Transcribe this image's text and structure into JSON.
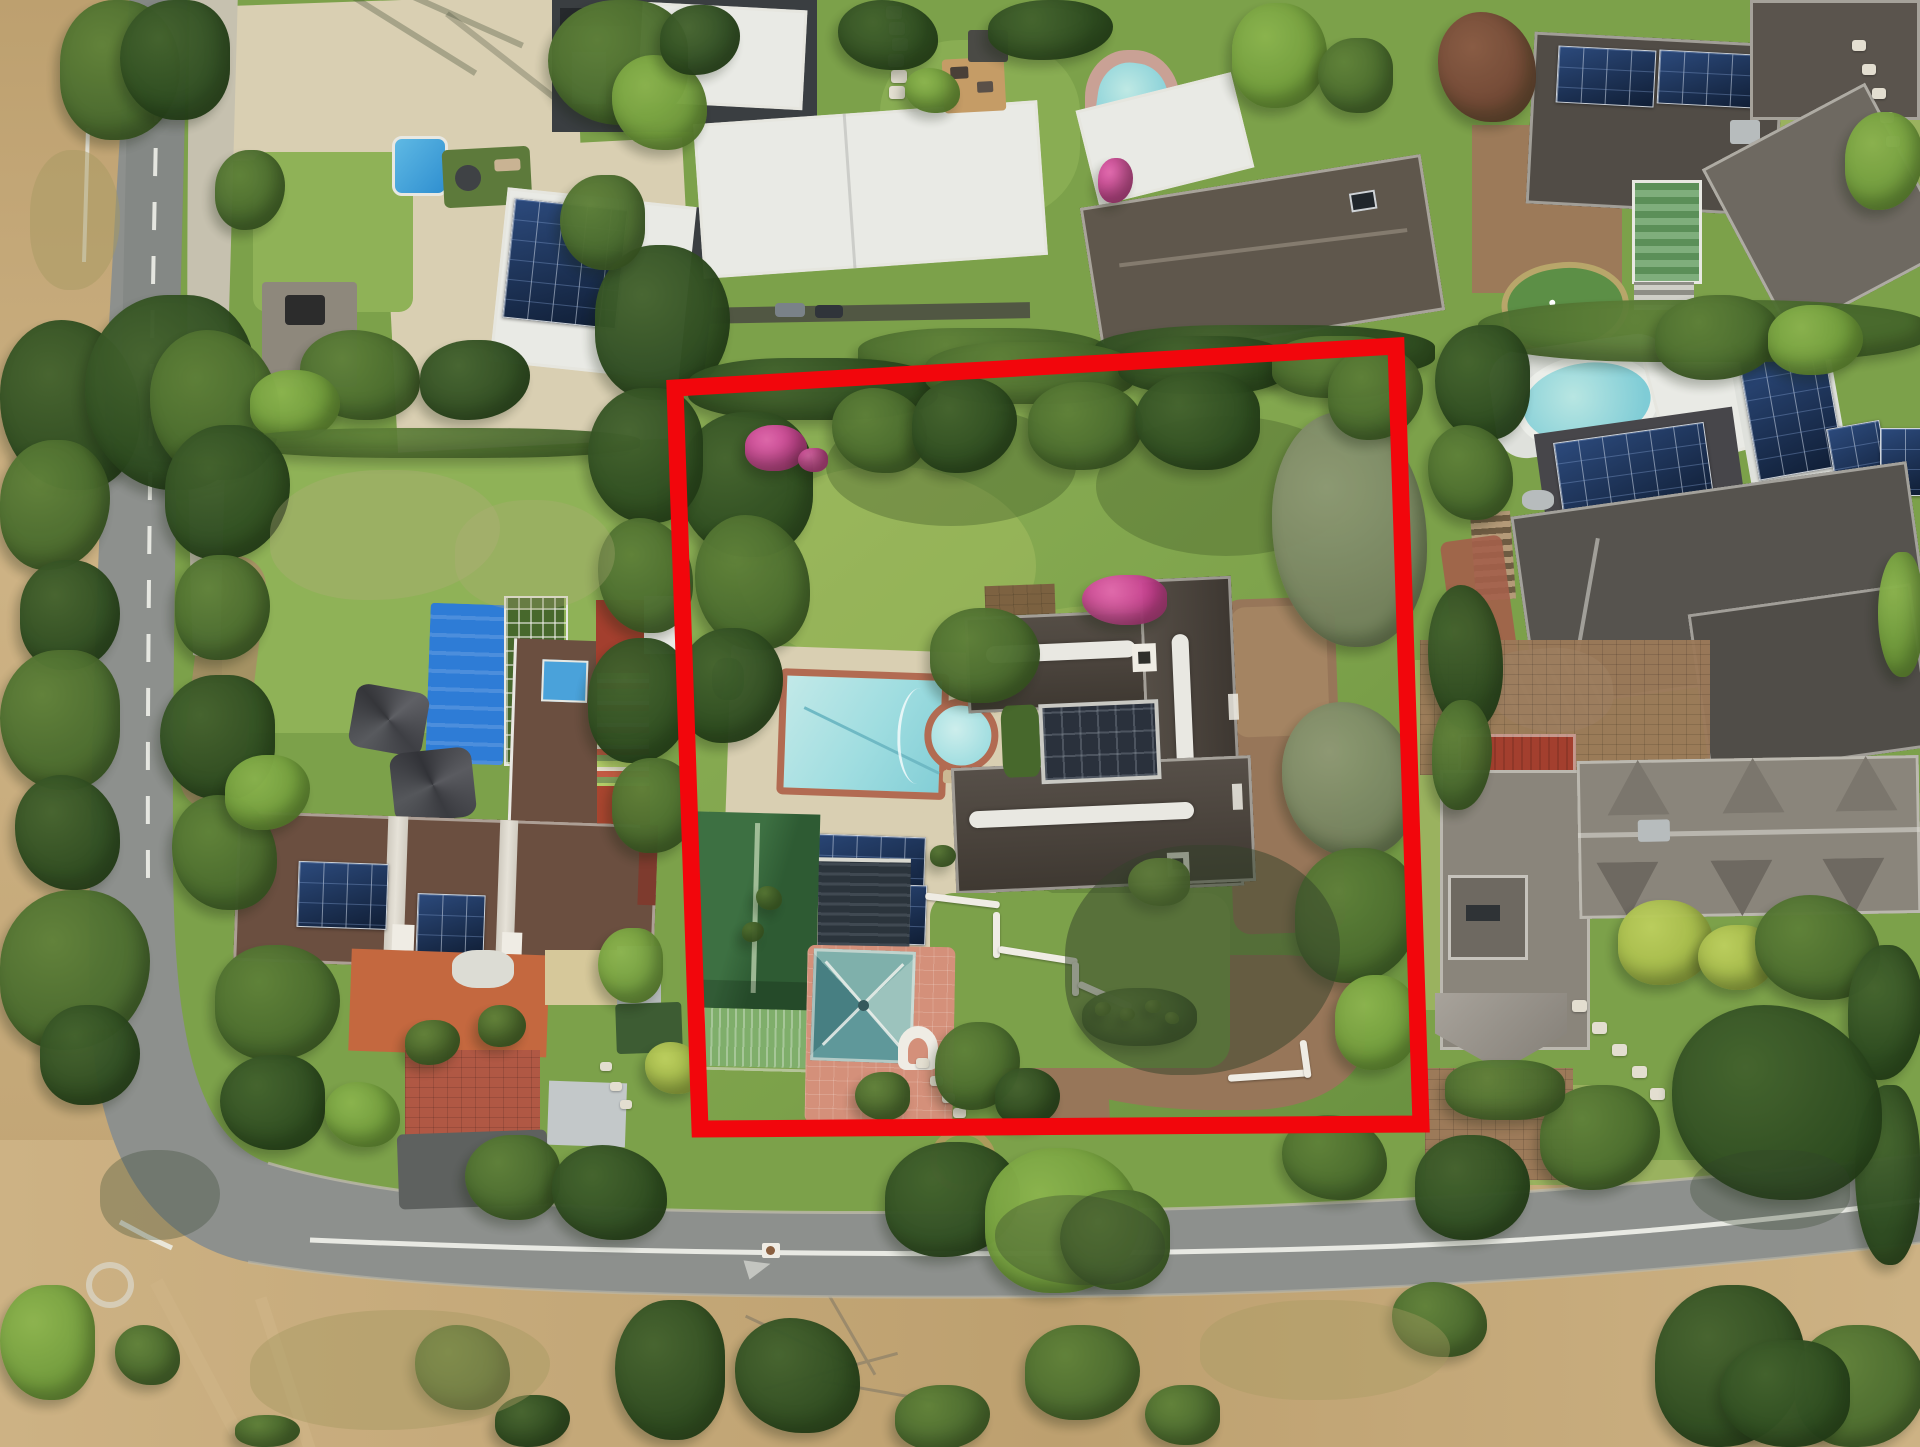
{
  "scene": {
    "type": "aerial-photograph",
    "description": "Top-down aerial drone photograph of a suburban residential neighborhood with lawns, pools, solar roofs, roads and dry parkland; one large plot with a Cape-Dutch style thatched house is outlined by a thick red property boundary.",
    "highlight": "red property boundary outline"
  },
  "boundary": {
    "points": "675,388 1396,346 1421,1124 700,1129",
    "stroke_width": 17
  },
  "roads": {
    "left_road_dash": "28 26",
    "marking_color": "#f0f1ea"
  },
  "palette": {
    "lawn_base": "#7ca14a",
    "lawn_bright": "#8fb257",
    "lawn_pale": "#9ab25f",
    "lawn_dark": "#6a9140",
    "scrub": "#bda06f",
    "scrub_light": "#cdb284",
    "sg": "#a79a62",
    "sg_l": "#a79a62",
    "road": "#8d908d",
    "road_dark": "#7c7f7d",
    "sidewalk": "#c6c1af",
    "curb": "#bdb9aa",
    "line_white": "#f0f1ea",
    "paving_cream": "#d9cfb2",
    "paving_pink": "#d4907a",
    "paving_brick": "#b05844",
    "paving_brown": "#9c7a59",
    "dirt": "#977659",
    "dirt_light": "#a98a67",
    "boundary_red": "#f2060c",
    "ridge_white": "#e9e8e2",
    "roof_white": "#e9eae5",
    "roof_pale": "#dfe1dc",
    "roof_charcoal": "#3a3e41",
    "roof_gray": "#8a857b",
    "roof_gray_dark": "#6e6961",
    "roof_taupe": "#5f574c",
    "roof_darkgray": "#514c46",
    "roof_slate": "#56534e",
    "roof_brown": "#6b4f40",
    "roof_maroon": "#7e3b2e",
    "roof_redtile": "#a33f2e",
    "roof_orange": "#c4683f",
    "roof_green": "#2e5b33",
    "roof_green_lit": "#3d7042",
    "roof_green_light": "#7fae6b",
    "roof_teal": "#4e8d90",
    "roof_teal_light": "#9cc3bd",
    "thatch": "#4a433c",
    "thatch_dark": "#3b3530",
    "glass_dark": "#2a313c",
    "pergola_dark": "#2b343c",
    "panel_dark": "#101e35",
    "panel_blue": "#2c4a7c",
    "pool_water": "#9fdde0",
    "pool_water_light": "#c2e9e8",
    "pool_water_deep": "#7fccd6",
    "pool_coping": "#b26b52",
    "pool_cover": "#2e7cd6",
    "pool_brick": "#c9a195",
    "putting_green": "#5c8f46",
    "fringe_tan": "#b8a66a",
    "tarp_blue": "#aebfcd",
    "deck_wood": "#c59c66",
    "metal_gray": "#b7bcbd",
    "cream_roof": "#d6c89a",
    "white_wall": "#efece4",
    "skylight_blue": "#4aa2da",
    "tank_green": "#2f5d38",
    "t1": "#2c4a1f",
    "t1_l": "#44632e",
    "t2": "#47682c",
    "t2_l": "#5f8139",
    "t3": "#6f9a3a",
    "t3_l": "#8bb44e",
    "t4": "#a3b747",
    "t4_l": "#bccf5e",
    "t5": "#75825e",
    "t5_l": "#8e9a74",
    "pink": "#c43b8c",
    "pink_l": "#e268ad",
    "maroon": "#6f4534",
    "maroon_l": "#8a5a44",
    "stone": "#e3ded0",
    "stone_l": "#e3ded0",
    "dry": "#b3ad7a",
    "dry_l": "#b3ad7a",
    "sh": "#33422a",
    "sh_l": "#33422a"
  },
  "vegetation": {
    "canopies": [
      [
        60,
        0,
        120,
        140,
        "t2"
      ],
      [
        120,
        0,
        110,
        120,
        "t1"
      ],
      [
        0,
        320,
        140,
        170,
        "t1"
      ],
      [
        0,
        440,
        110,
        130,
        "t2"
      ],
      [
        20,
        560,
        100,
        110,
        "t1"
      ],
      [
        0,
        650,
        120,
        140,
        "t2"
      ],
      [
        15,
        775,
        105,
        115,
        "t1"
      ],
      [
        0,
        890,
        150,
        160,
        "t2"
      ],
      [
        40,
        1005,
        100,
        100,
        "t1"
      ],
      [
        85,
        295,
        170,
        195,
        "t1"
      ],
      [
        150,
        330,
        130,
        150,
        "t2"
      ],
      [
        215,
        150,
        70,
        80,
        "t2"
      ],
      [
        30,
        150,
        90,
        140,
        "sg",
        0.5
      ],
      [
        548,
        0,
        140,
        125,
        "t2"
      ],
      [
        612,
        55,
        95,
        95,
        "t3"
      ],
      [
        660,
        5,
        80,
        70,
        "t1"
      ],
      [
        595,
        245,
        135,
        155,
        "t1"
      ],
      [
        560,
        175,
        85,
        95,
        "t2"
      ],
      [
        300,
        330,
        120,
        90,
        "t2"
      ],
      [
        420,
        340,
        110,
        80,
        "t1"
      ],
      [
        250,
        370,
        90,
        70,
        "t3"
      ],
      [
        240,
        428,
        400,
        30,
        "t2",
        0.9,
        "40%"
      ],
      [
        838,
        0,
        100,
        70,
        "t1"
      ],
      [
        988,
        0,
        125,
        60,
        "t1"
      ],
      [
        1232,
        3,
        95,
        105,
        "t3"
      ],
      [
        1318,
        38,
        75,
        75,
        "t2"
      ],
      [
        905,
        68,
        55,
        45,
        "t3"
      ],
      [
        1098,
        158,
        35,
        45,
        "pink"
      ],
      [
        858,
        328,
        250,
        55,
        "t2",
        0.95,
        "40%"
      ],
      [
        1095,
        325,
        340,
        55,
        "t1",
        0.95,
        "40%"
      ],
      [
        1438,
        12,
        98,
        110,
        "maroon"
      ],
      [
        1845,
        112,
        78,
        98,
        "t3"
      ],
      [
        1478,
        300,
        450,
        62,
        "t2",
        0.95,
        "40%"
      ],
      [
        1435,
        325,
        95,
        115,
        "t1"
      ],
      [
        1428,
        425,
        85,
        95,
        "t2"
      ],
      [
        1655,
        295,
        125,
        85,
        "t2"
      ],
      [
        1768,
        305,
        95,
        70,
        "t3"
      ],
      [
        1878,
        552,
        45,
        125,
        "t3"
      ],
      [
        1428,
        585,
        75,
        145,
        "t1"
      ],
      [
        1432,
        700,
        60,
        110,
        "t2"
      ],
      [
        1618,
        900,
        95,
        85,
        "t4"
      ],
      [
        1698,
        925,
        75,
        65,
        "t4"
      ],
      [
        1755,
        895,
        125,
        105,
        "t2"
      ],
      [
        1848,
        945,
        75,
        135,
        "t1"
      ],
      [
        1415,
        1135,
        115,
        105,
        "t1"
      ],
      [
        1855,
        1085,
        65,
        180,
        "t1"
      ],
      [
        1672,
        1005,
        210,
        195,
        "t1"
      ],
      [
        1540,
        1085,
        120,
        105,
        "t2"
      ],
      [
        1445,
        1060,
        120,
        60,
        "t2",
        0.95,
        "40%"
      ],
      [
        688,
        358,
        250,
        62,
        "t1",
        0.97,
        "40%"
      ],
      [
        925,
        342,
        210,
        62,
        "t2",
        0.97,
        "40%"
      ],
      [
        1118,
        336,
        170,
        58,
        "t1",
        0.97,
        "40%"
      ],
      [
        1272,
        336,
        135,
        62,
        "t2",
        0.97,
        "40%"
      ],
      [
        678,
        412,
        135,
        145,
        "t1"
      ],
      [
        695,
        515,
        115,
        135,
        "t2"
      ],
      [
        678,
        628,
        105,
        115,
        "t1"
      ],
      [
        745,
        425,
        62,
        46,
        "pink"
      ],
      [
        798,
        448,
        30,
        24,
        "pink"
      ],
      [
        832,
        388,
        95,
        85,
        "t2"
      ],
      [
        912,
        378,
        105,
        95,
        "t1"
      ],
      [
        1028,
        382,
        115,
        88,
        "t2"
      ],
      [
        1135,
        372,
        125,
        98,
        "t1"
      ],
      [
        1272,
        412,
        155,
        235,
        "t5"
      ],
      [
        1328,
        348,
        95,
        92,
        "t2"
      ],
      [
        930,
        608,
        110,
        95,
        "t2"
      ],
      [
        1082,
        575,
        85,
        50,
        "pink"
      ],
      [
        1282,
        702,
        135,
        155,
        "t5"
      ],
      [
        1295,
        848,
        125,
        135,
        "t2"
      ],
      [
        1335,
        975,
        85,
        95,
        "t3"
      ],
      [
        1128,
        858,
        62,
        48,
        "t3"
      ],
      [
        1082,
        988,
        115,
        58,
        "t2",
        0.97,
        "45%"
      ],
      [
        1095,
        1002,
        16,
        14,
        "t3"
      ],
      [
        1120,
        1008,
        15,
        13,
        "t3"
      ],
      [
        1145,
        1000,
        16,
        13,
        "t3"
      ],
      [
        1165,
        1012,
        14,
        12,
        "t3"
      ],
      [
        935,
        1022,
        85,
        88,
        "t2"
      ],
      [
        995,
        1068,
        65,
        58,
        "t1"
      ],
      [
        855,
        1072,
        55,
        48,
        "t2"
      ],
      [
        756,
        886,
        26,
        24,
        "t2"
      ],
      [
        742,
        922,
        22,
        20,
        "t2"
      ],
      [
        930,
        845,
        26,
        22,
        "t2"
      ],
      [
        588,
        388,
        115,
        135,
        "t1"
      ],
      [
        598,
        518,
        95,
        115,
        "t2"
      ],
      [
        588,
        638,
        105,
        125,
        "t1"
      ],
      [
        612,
        758,
        85,
        95,
        "t2"
      ],
      [
        598,
        928,
        65,
        75,
        "t3"
      ],
      [
        645,
        1042,
        58,
        52,
        "t4"
      ],
      [
        165,
        425,
        125,
        135,
        "t1"
      ],
      [
        175,
        555,
        95,
        105,
        "t2"
      ],
      [
        160,
        675,
        115,
        125,
        "t1"
      ],
      [
        172,
        795,
        105,
        115,
        "t2"
      ],
      [
        225,
        755,
        85,
        75,
        "t3"
      ],
      [
        215,
        945,
        125,
        115,
        "t2"
      ],
      [
        220,
        1055,
        105,
        95,
        "t1"
      ],
      [
        325,
        1082,
        75,
        65,
        "t3"
      ],
      [
        405,
        1020,
        55,
        45,
        "t2"
      ],
      [
        478,
        1005,
        48,
        42,
        "t2"
      ],
      [
        465,
        1135,
        95,
        85,
        "t2"
      ],
      [
        552,
        1145,
        115,
        95,
        "t1"
      ],
      [
        885,
        1142,
        135,
        115,
        "t1"
      ],
      [
        985,
        1148,
        155,
        145,
        "t3"
      ],
      [
        1060,
        1190,
        110,
        100,
        "t2"
      ],
      [
        1282,
        1115,
        105,
        85,
        "t2"
      ],
      [
        1065,
        845,
        275,
        230,
        "sh",
        0.5
      ],
      [
        100,
        1150,
        120,
        90,
        "sh",
        0.3
      ],
      [
        1690,
        1150,
        160,
        80,
        "sh",
        0.3
      ],
      [
        995,
        1195,
        170,
        90,
        "sh",
        0.35
      ],
      [
        270,
        470,
        230,
        130,
        "dry",
        0.35
      ],
      [
        455,
        500,
        160,
        110,
        "dry",
        0.3
      ],
      [
        615,
        1300,
        110,
        140,
        "t1"
      ],
      [
        735,
        1318,
        125,
        115,
        "t1"
      ],
      [
        895,
        1385,
        95,
        65,
        "t2"
      ],
      [
        1025,
        1325,
        115,
        95,
        "t2"
      ],
      [
        1145,
        1385,
        75,
        60,
        "t2"
      ],
      [
        1392,
        1282,
        95,
        75,
        "t2"
      ],
      [
        1655,
        1285,
        150,
        162,
        "t1"
      ],
      [
        1795,
        1325,
        130,
        122,
        "t2"
      ],
      [
        1720,
        1340,
        130,
        107,
        "t1"
      ],
      [
        415,
        1325,
        95,
        85,
        "t2"
      ],
      [
        495,
        1395,
        75,
        52,
        "t1"
      ],
      [
        235,
        1415,
        65,
        32,
        "t2"
      ],
      [
        0,
        1285,
        95,
        115,
        "t3"
      ],
      [
        115,
        1325,
        65,
        60,
        "t2"
      ],
      [
        250,
        1310,
        300,
        120,
        "sg",
        0.45
      ],
      [
        1200,
        1300,
        250,
        100,
        "sg",
        0.4
      ]
    ],
    "stones": [
      [
        886,
        6
      ],
      [
        889,
        22
      ],
      [
        892,
        38
      ],
      [
        888,
        54
      ],
      [
        891,
        70
      ],
      [
        889,
        86
      ],
      [
        1852,
        40,
        14,
        11
      ],
      [
        1862,
        64,
        14,
        11
      ],
      [
        1872,
        88,
        14,
        11
      ],
      [
        1880,
        112,
        14,
        11
      ],
      [
        1886,
        136,
        14,
        11
      ],
      [
        1572,
        1000,
        15,
        12
      ],
      [
        1592,
        1022,
        15,
        12
      ],
      [
        1612,
        1044,
        15,
        12
      ],
      [
        1632,
        1066,
        15,
        12
      ],
      [
        1650,
        1088,
        15,
        12
      ],
      [
        916,
        1058,
        13,
        10
      ],
      [
        930,
        1076,
        13,
        10
      ],
      [
        942,
        1093,
        13,
        10
      ],
      [
        953,
        1108,
        13,
        10
      ],
      [
        600,
        1062,
        12,
        9
      ],
      [
        610,
        1082,
        12,
        9
      ],
      [
        620,
        1100,
        12,
        9
      ]
    ]
  }
}
